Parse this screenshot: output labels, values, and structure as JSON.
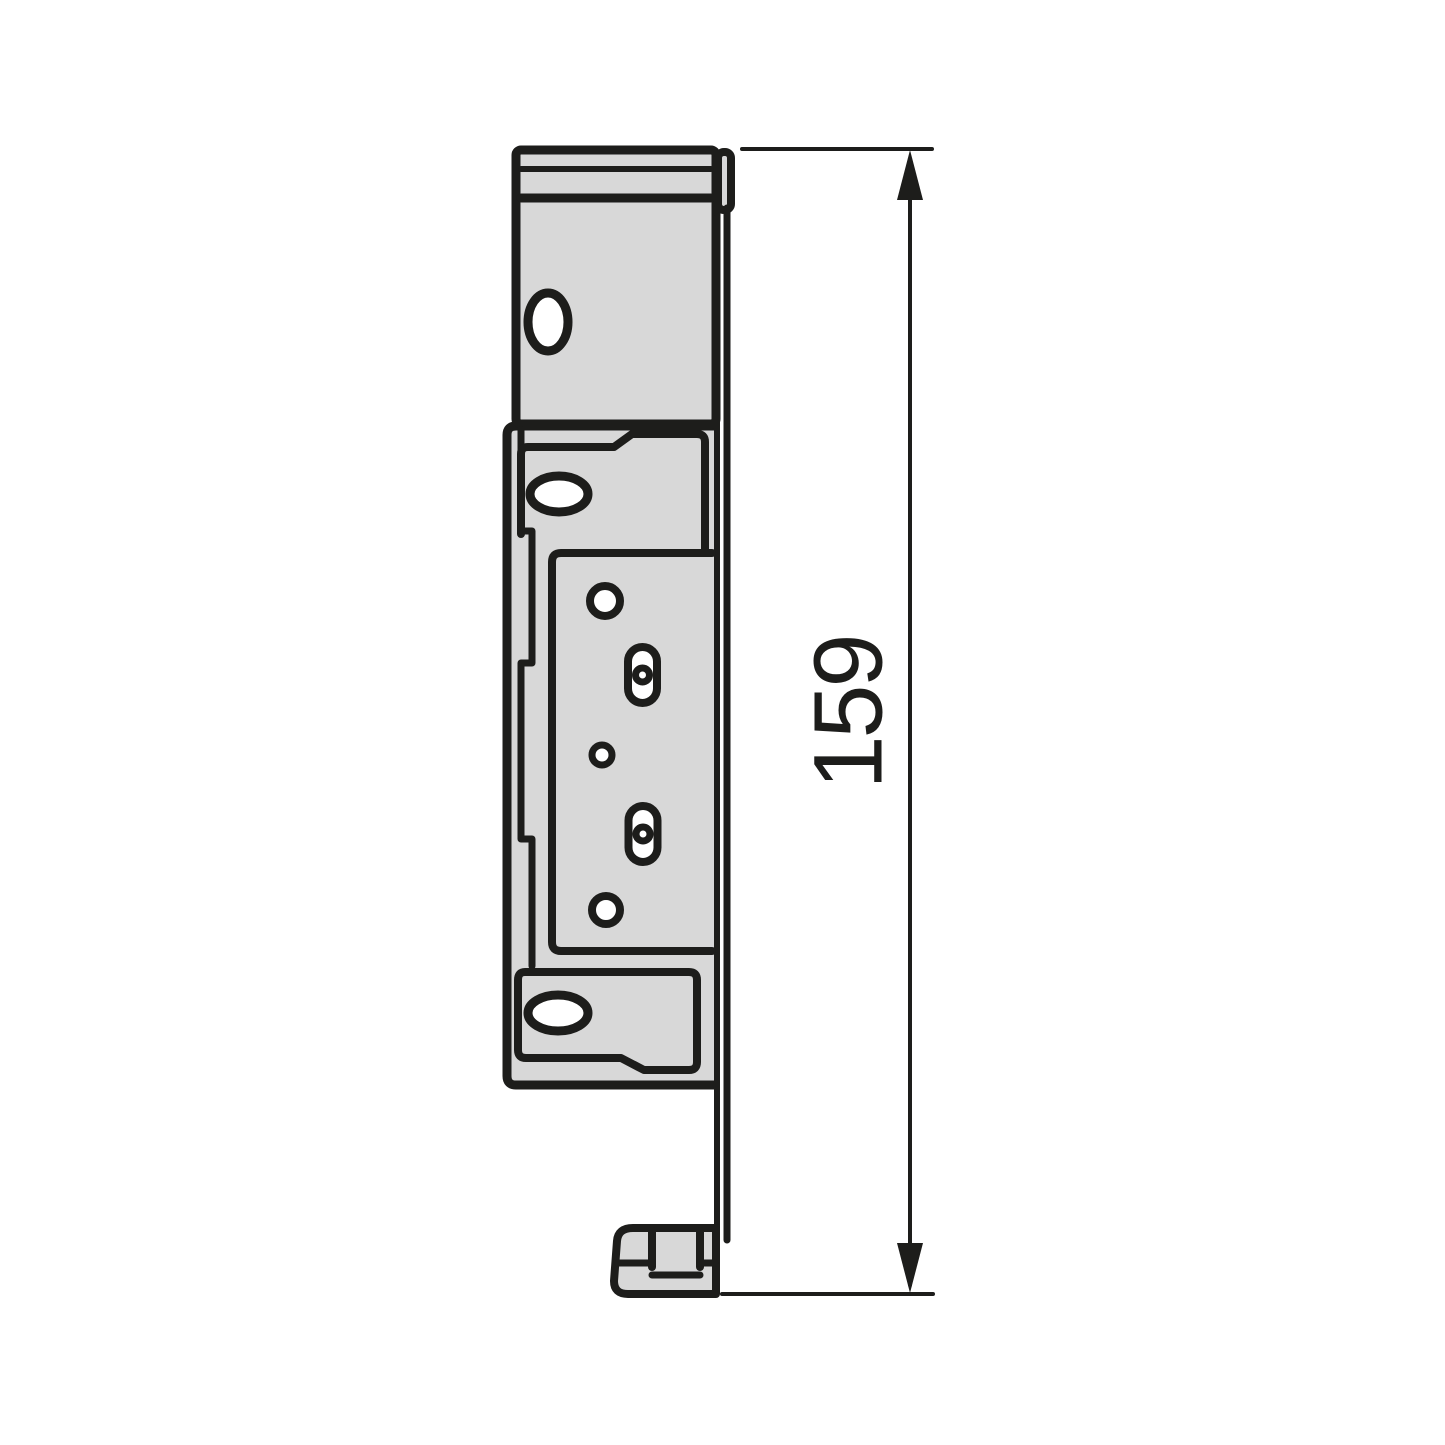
{
  "drawing": {
    "kind": "technical-drawing",
    "dimension": {
      "value": "159"
    },
    "colors": {
      "part_fill": "#d8d8d8",
      "hole_fill": "#ffffff",
      "line": "#1d1d1b",
      "background": "#ffffff"
    }
  }
}
